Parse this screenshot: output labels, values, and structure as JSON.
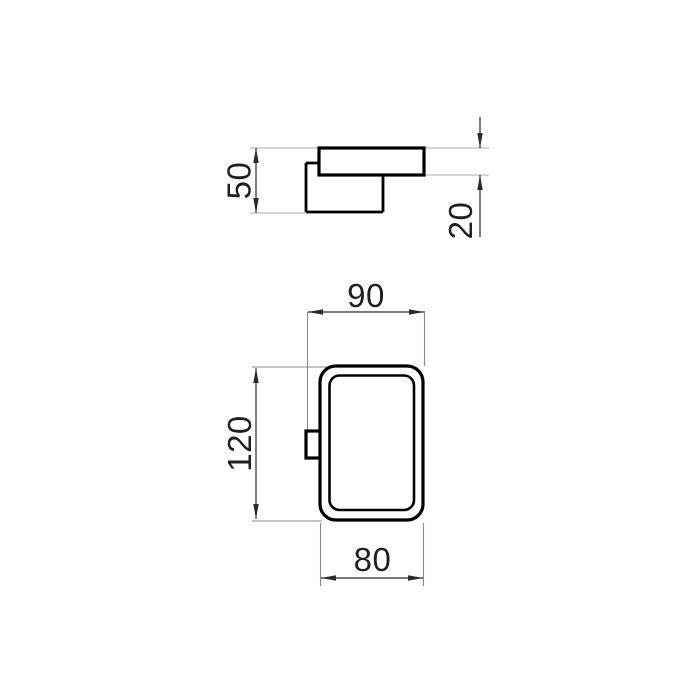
{
  "diagram": {
    "views": {
      "top": {
        "dimensions": {
          "depth": "50",
          "plate_thickness": "20"
        }
      },
      "front": {
        "dimensions": {
          "overall_width": "90",
          "height": "120",
          "body_width": "80"
        }
      }
    },
    "colors": {
      "background": "#ffffff",
      "object_line": "#000000",
      "dimension_line": "#2b2b2b",
      "extension_line_light": "#ababab",
      "extension_line_dark": "#8a8a8a",
      "label_text": "#1f1f1f"
    }
  }
}
